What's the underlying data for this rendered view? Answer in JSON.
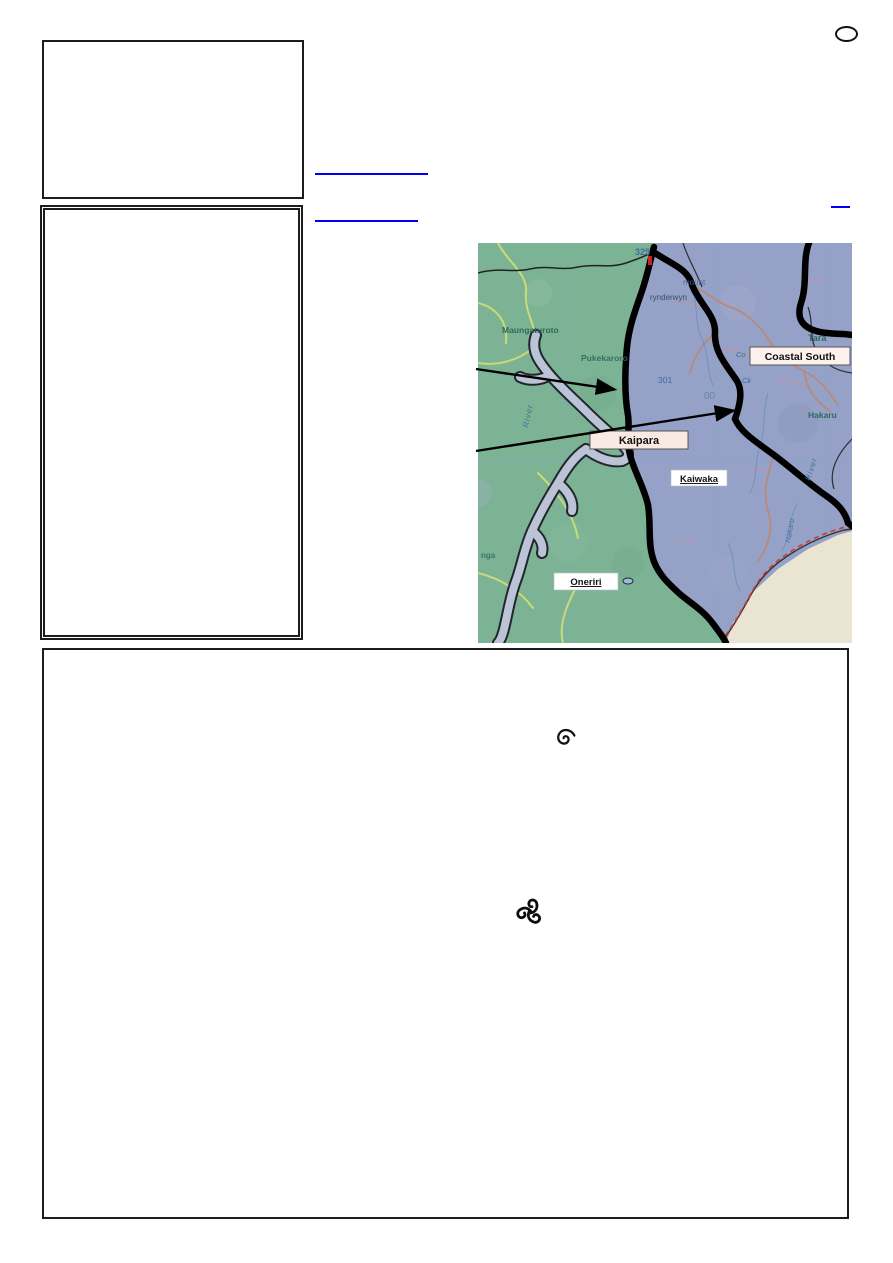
{
  "document": {
    "background": "#ffffff",
    "border_color": "#1c1c1c"
  },
  "hyperlinks": {
    "color": "#0000ee"
  },
  "map": {
    "district_labels": {
      "coastal_south": "Coastal South",
      "kaipara": "Kaipara",
      "kaiwaka": "Kaiwaka",
      "oneriri": "Oneriri"
    },
    "place_names": {
      "maungaturoto": "Maungaturoto",
      "pukekaroro": "Pukekaroro",
      "brynderwyn": "rynderwyn",
      "mount_fragment": "mount",
      "tara": "Tara",
      "hakaru": "Hakaru",
      "hakaru_vertical": "Hakaru",
      "river_west": "River",
      "river_east": "River",
      "nga_fragment": "nga",
      "creek_co": "Co",
      "creek_ck": "Ck",
      "grid_00": "00"
    },
    "spot_heights": {
      "h325": "325",
      "h301": "301"
    },
    "colors": {
      "land_west": "#7cb394",
      "land_east": "#95a1c6",
      "water": "#bac4d6",
      "boundary": "#000000",
      "coastal_south_box": "#fdf1ed",
      "kaipara_box": "#fbeae4"
    }
  },
  "symbols": {
    "spiral": "single-spiral",
    "triskelion": "triple-spiral"
  }
}
